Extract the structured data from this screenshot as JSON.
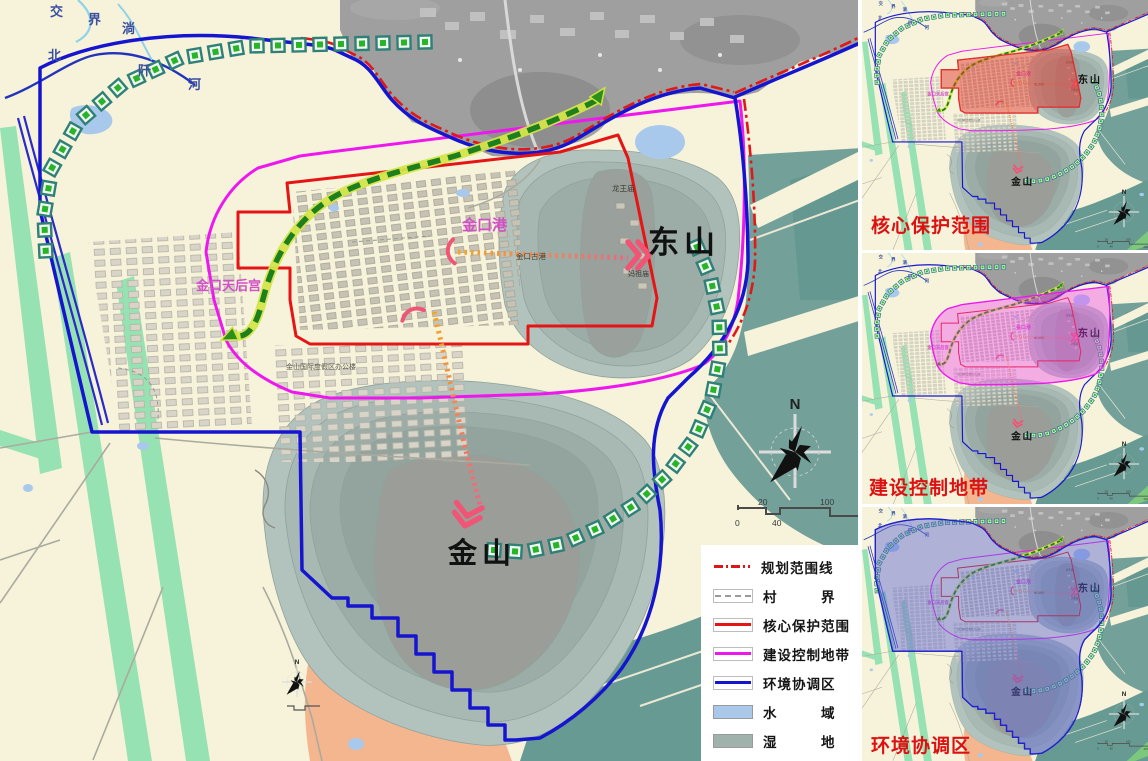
{
  "map": {
    "mountains": {
      "dongshan": "东山",
      "jinshan": "金山"
    },
    "places": {
      "jinkou_port": "金口港",
      "tianhou_palace": "金口天后宫",
      "ancient_port": "金口古港",
      "longwang_temple": "龙王庙",
      "mazu_temple": "妈祖庙",
      "resort_office": "金山国际度假区办公楼"
    },
    "rivers": {
      "jiao": "交",
      "jie": "界",
      "tang": "淌",
      "bei": "北",
      "qian": "阡",
      "he": "河"
    },
    "compass": {
      "north": "N"
    },
    "scalebar": {
      "top_20": "20",
      "top_100": "100",
      "bottom_0": "0",
      "bottom_40": "40",
      "bottom_200": "200m"
    }
  },
  "legend": {
    "items": [
      {
        "label": "规划范围线"
      },
      {
        "label": "村　　　界"
      },
      {
        "label": "核心保护范围"
      },
      {
        "label": "建设控制地带"
      },
      {
        "label": "环境协调区"
      },
      {
        "label": "水　　　域"
      },
      {
        "label": "湿　　　地"
      }
    ]
  },
  "minimaps": [
    {
      "caption": "核心保护范围"
    },
    {
      "caption": "建设控制地带"
    },
    {
      "caption": "环境协调区"
    }
  ],
  "colors": {
    "core_red": "#e51515",
    "control_magenta": "#ee18ee",
    "coordination_blue": "#1515d0",
    "water": "#aac8ea",
    "wetland": "#9fb2ac",
    "caption_red": "#dd1111",
    "background_cream": "#f6f3da"
  }
}
